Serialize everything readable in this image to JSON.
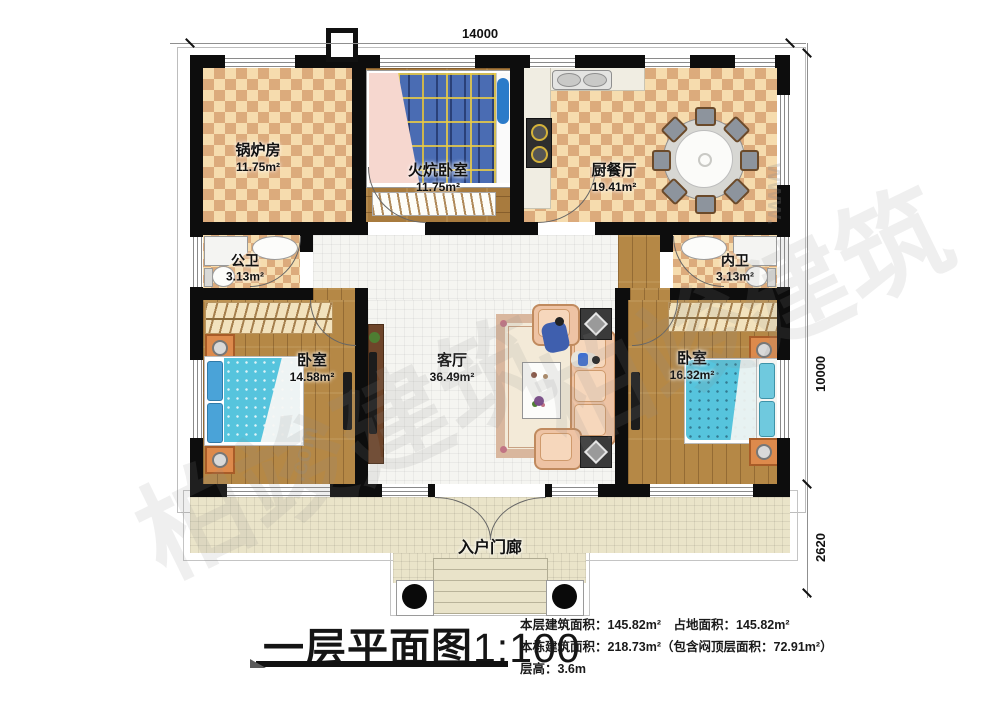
{
  "title": {
    "text": "一层平面图",
    "scale": "1:100"
  },
  "info": {
    "lines": [
      "本层建筑面积：145.82m²　占地面积：145.82m²",
      "本栋建筑面积：218.73m²（包含闷顶层面积：72.91m²）",
      "层高：3.6m"
    ]
  },
  "dimensions": {
    "top": "14000",
    "right_upper": "10000",
    "right_lower": "2620"
  },
  "rooms": {
    "boiler": {
      "name": "锅炉房",
      "area": "11.75m²"
    },
    "kang": {
      "name": "火炕卧室",
      "area": "11.75m²"
    },
    "kitchen": {
      "name": "厨餐厅",
      "area": "19.41m²"
    },
    "bath_left": {
      "name": "公卫",
      "area": "3.13m²"
    },
    "bath_right": {
      "name": "内卫",
      "area": "3.13m²"
    },
    "bed_left": {
      "name": "卧室",
      "area": "14.58m²"
    },
    "living": {
      "name": "客厅",
      "area": "36.49m²"
    },
    "bed_right": {
      "name": "卧室",
      "area": "16.32m²"
    },
    "porch": {
      "name": "入户门廊"
    }
  },
  "watermark": {
    "text": "柏竣建筑",
    "frag1": "www.",
    "frag2": ".com"
  },
  "colors": {
    "wall": "#0d0d0d",
    "checker_light": "#f6dcae",
    "checker_dark": "#dcab7c",
    "tile": "#f5f5f1",
    "porch": "#eae4c9",
    "bed_plaid": "#4a6cb3",
    "bed_teal": "#56c4dd",
    "sofa": "#eec3a4",
    "accent_orange": "#dd8a4c"
  }
}
